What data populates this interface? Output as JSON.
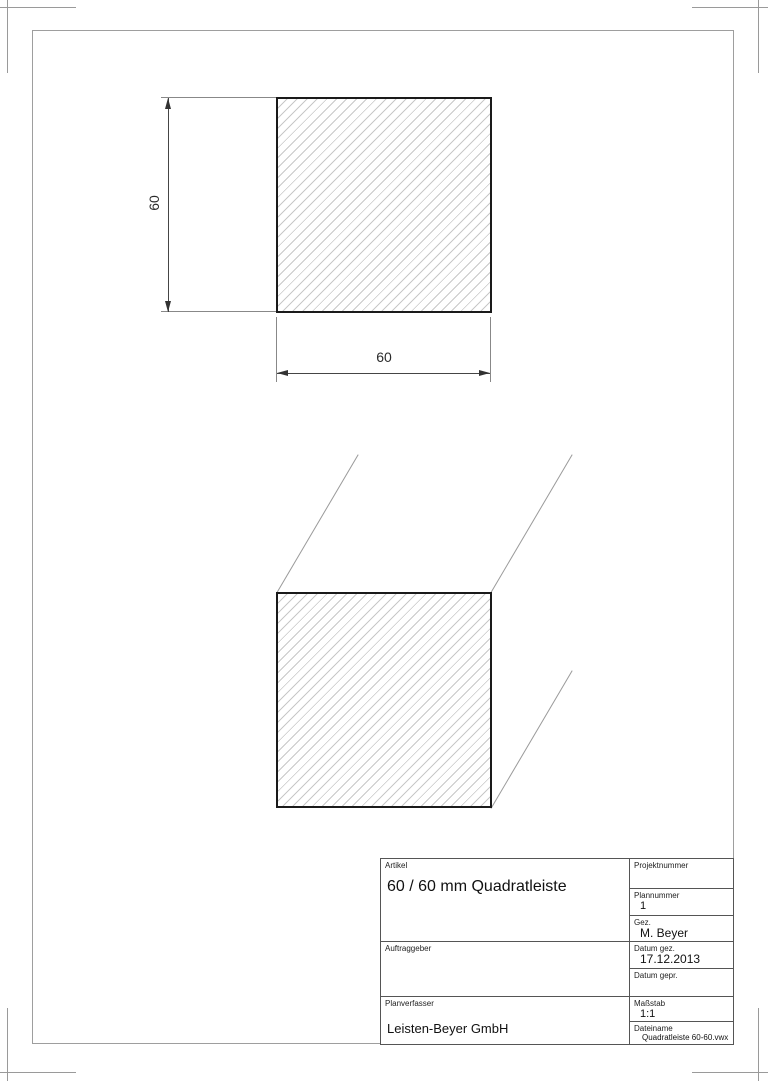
{
  "colors": {
    "paper": "#ffffff",
    "frame_line": "#9e9e9e",
    "object_outline": "#1a1a1a",
    "hatch_line": "#c8c8c8",
    "dimension_line": "#454545",
    "text": "#1f1f1f"
  },
  "top_view": {
    "height_label": "60",
    "width_label": "60"
  },
  "title_block": {
    "artikel": {
      "label": "Artikel",
      "value": "60 / 60 mm Quadratleiste"
    },
    "auftraggeber": {
      "label": "Auftraggeber",
      "value": ""
    },
    "planverfasser": {
      "label": "Planverfasser",
      "value": "Leisten-Beyer GmbH"
    },
    "projektnummer": {
      "label": "Projektnummer",
      "value": ""
    },
    "plannummer": {
      "label": "Plannummer",
      "value": "1"
    },
    "gez": {
      "label": "Gez.",
      "value": "M. Beyer"
    },
    "datum_gez": {
      "label": "Datum gez.",
      "value": "17.12.2013"
    },
    "datum_gepr": {
      "label": "Datum gepr.",
      "value": ""
    },
    "massstab": {
      "label": "Maßstab",
      "value": "1:1"
    },
    "dateiname": {
      "label": "Dateiname",
      "value": "Quadratleiste 60-60.vwx"
    }
  }
}
